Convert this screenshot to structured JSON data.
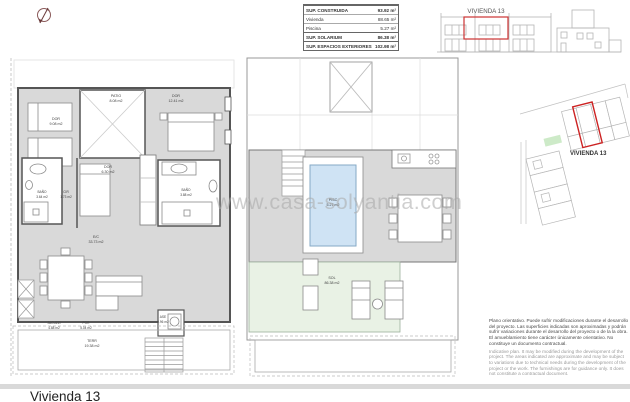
{
  "watermark": {
    "text": "www.casa-solyantia.com"
  },
  "areas_table": {
    "rows": [
      {
        "label": "SUP. CONSTRUIDA",
        "value": "93.92 m²"
      },
      {
        "label": "Vivienda",
        "value": "88.65 m²"
      },
      {
        "label": "Piscina",
        "value": "5.27 m²"
      },
      {
        "label": "SUP. SOLARIUM",
        "value": "86.38 m²"
      },
      {
        "label": "SUP. ESPACIOS EXTERIORES",
        "value": "102.98 m²"
      }
    ]
  },
  "elevation": {
    "label": "VIVIENDA 13"
  },
  "site_plan": {
    "label": "VIVIENDA 13"
  },
  "ground_floor": {
    "rooms": [
      {
        "name": "DOR",
        "area": "9.08 m2"
      },
      {
        "name": "PATIO",
        "area": "8.08 m2"
      },
      {
        "name": "DOR",
        "area": "12.41 m2"
      },
      {
        "name": "DOR",
        "area": "6.30 m2"
      },
      {
        "name": "BAÑO",
        "area": "3.64 m2"
      },
      {
        "name": "CIR",
        "area": "1.73 m2"
      },
      {
        "name": "BAÑO",
        "area": "3.88 m2"
      },
      {
        "name": "E/C",
        "area": "33.73 m2"
      },
      {
        "name": "ASE",
        "area": "0.96 m2"
      },
      {
        "name": "JACUZZI",
        "area": "4.88 m2"
      },
      {
        "name": "POR",
        "area": "5.04 m2"
      },
      {
        "name": "TERR",
        "area": "19.38 m2"
      }
    ]
  },
  "solarium_floor": {
    "rooms": [
      {
        "name": "PISC",
        "area": "5.27 m2"
      },
      {
        "name": "SOL",
        "area": "86.38 m2"
      }
    ]
  },
  "disclaimer": {
    "es": "Plano orientativo. Puede sufrir modificaciones durante el desarrollo del proyecto. Las superficies indicadas son aproximadas y podrán sufrir variaciones durante el desarrollo del proyecto o de la la obra. El amueblamiento tiene carácter únicamente orientativo. No constituye un documento contractual.",
    "en": "Indicative plan. It may be modified during the development of the project. The areas indicated are approximate and may be subject to variations due to technical needs during the development of the project or the work. The furnishings are for guidance only. It does not constitute a contractual document."
  },
  "footer": {
    "title": "Vivienda 13"
  },
  "colors": {
    "accent_red": "#cc2f2f",
    "deck_gray": "#d9d9d9",
    "pool_blue": "#cfe3f4",
    "solarium_green": "#e9f2e5"
  }
}
